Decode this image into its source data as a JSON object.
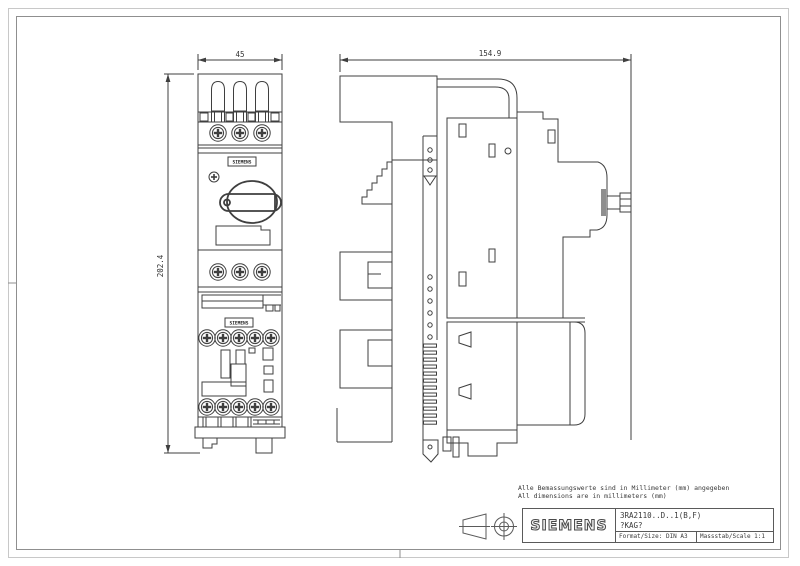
{
  "page": {
    "background": "#ffffff",
    "drawing_line_color": "#3f3f3f",
    "border_outer_color": "#c8c8c8",
    "border_inner_color": "#8f8f8f"
  },
  "notes": {
    "de": "Alle Bemassungswerte sind in Millimeter (mm) angegeben",
    "en": "All dimensions are in millimeters (mm)"
  },
  "dimensions": {
    "front_width": "45",
    "front_height": "202.4",
    "side_depth": "154.9"
  },
  "device_labels": {
    "breaker_brand": "SIEMENS",
    "contactor_brand": "SIEMENS"
  },
  "title_block": {
    "brand": "SIEMENS",
    "part_number": "3RA2110..D..1(B,F)",
    "reference": "?KAG?",
    "format_label": "Format/Size: DIN A3",
    "scale_label": "Massstab/Scale 1:1"
  }
}
